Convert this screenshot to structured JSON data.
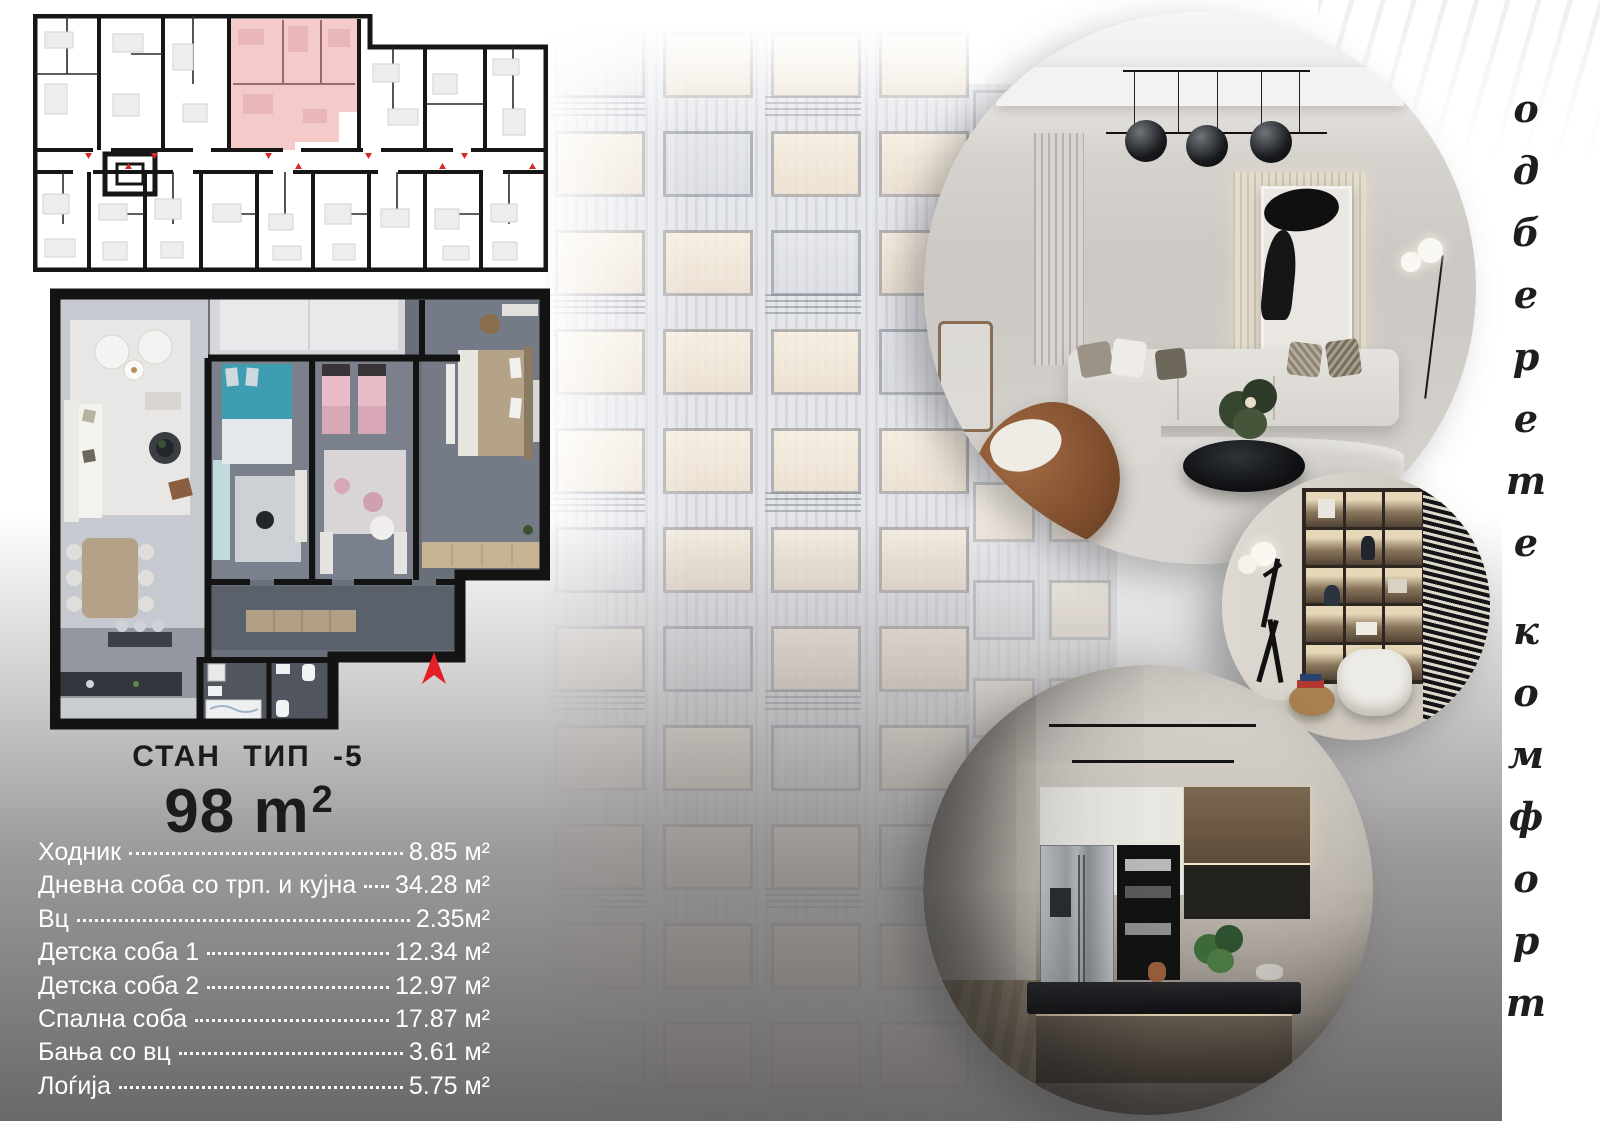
{
  "title_block": {
    "type_label": "СТАН ТИП -5",
    "area_number": "98 m",
    "area_sup": "2"
  },
  "rooms": [
    {
      "label": "Ходник",
      "area": "8.85 м²"
    },
    {
      "label": "Дневна соба со трп. и кујна",
      "area": "34.28 м²"
    },
    {
      "label": "Вц",
      "area": "2.35м²"
    },
    {
      "label": "Детска соба 1",
      "area": "12.34 м²"
    },
    {
      "label": "Детска соба 2",
      "area": "12.97 м²"
    },
    {
      "label": "Спална соба",
      "area": "17.87 м²"
    },
    {
      "label": "Бања со вц",
      "area": "3.61 м²"
    },
    {
      "label": "Лоѓија",
      "area": "5.75 м²"
    }
  ],
  "tagline": {
    "word1": "одберете",
    "word2": "комфорт"
  },
  "colors": {
    "highlight_unit_pink": "#f5cbca",
    "north_arrow_red": "#e31e24",
    "wall_black": "#151515",
    "list_text_white": "#ffffff",
    "fog_gray": "#656363"
  }
}
